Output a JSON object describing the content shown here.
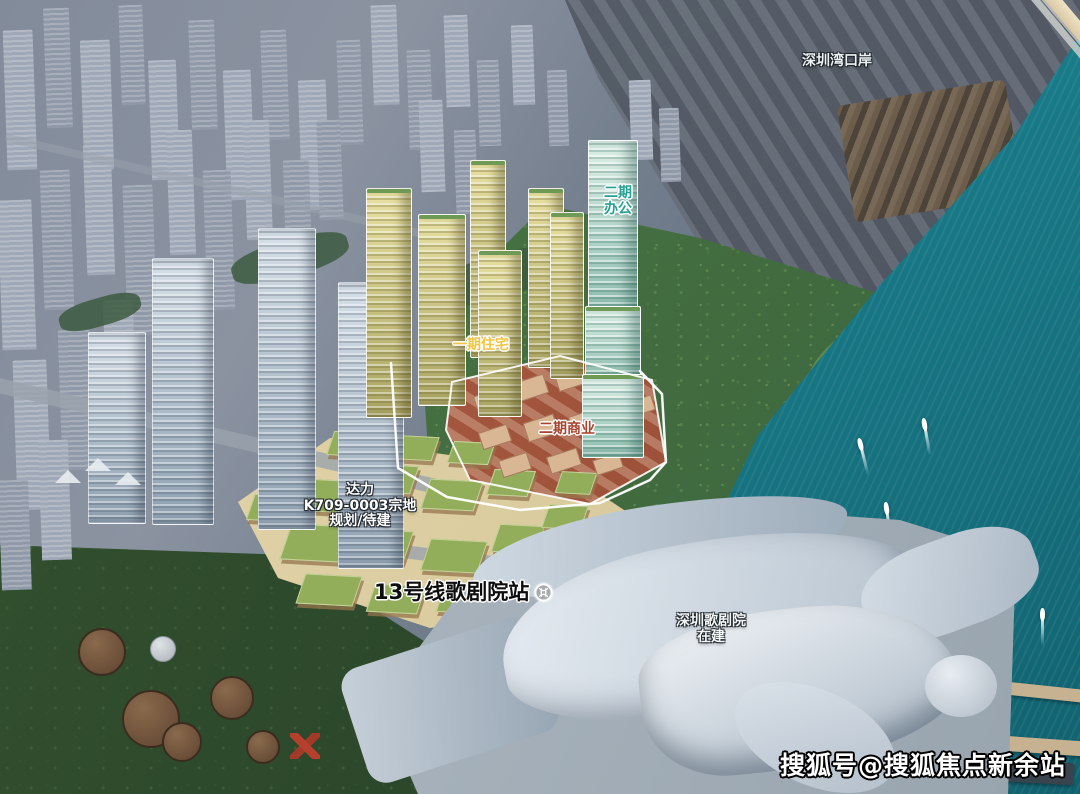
{
  "labels": {
    "port": {
      "text": "深圳湾口岸"
    },
    "phase2_office": {
      "line1": "二期",
      "line2": "办公",
      "color": "#27a195"
    },
    "phase1_residential": {
      "text": "一期住宅",
      "color": "#f2c63e"
    },
    "phase2_commercial": {
      "text": "二期商业",
      "color": "#a8432d"
    },
    "plot": {
      "line1": "达力",
      "line2": "K709-0003宗地",
      "line3": "规划/待建"
    },
    "metro": {
      "text": "13号线歌剧院站",
      "icon": "shenzhen-metro-icon"
    },
    "opera": {
      "line1": "深圳歌剧院",
      "line2": "在建"
    },
    "watermark": {
      "text": "搜狐号@搜狐焦点新余站"
    }
  },
  "colors": {
    "water_teal": "#1a7e8c",
    "office_label_teal": "#27a195",
    "residential_label_yellow": "#f2c63e",
    "commercial_label_red": "#a8432d",
    "commercial_zone": "#a55a42",
    "residential_towers": "#c8c27e",
    "office_tower": "#a5cdbf"
  }
}
